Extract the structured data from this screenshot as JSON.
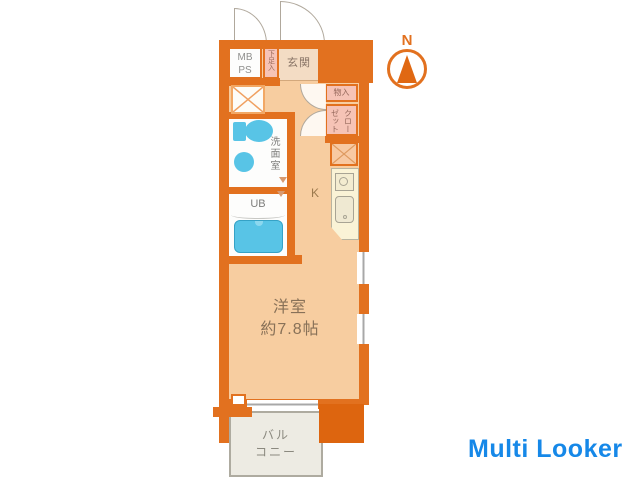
{
  "colors": {
    "wall": "#e2711f",
    "wall_dark": "#dd650f",
    "floor_peach": "#f7cda0",
    "entrance_floor": "#f3dcc4",
    "storage_pink": "#f6c3b6",
    "fixture_blue": "#58c4e6",
    "kitchen_cream": "#faf3d6",
    "balcony_fill": "#edebe3",
    "label_gray": "#7e7e7c",
    "room_label_brown": "#887158",
    "watermark_blue": "#1688e8",
    "compass_orange": "#e2711f"
  },
  "plan": {
    "mbps": {
      "line1": "MB",
      "line2": "PS"
    },
    "shoe_storage": "下足入",
    "entrance": "玄関",
    "storage": "物入",
    "closet": "クローゼット",
    "washroom": "洗面室",
    "unit_bath": "UB",
    "kitchen": "K",
    "main_room": {
      "name": "洋室",
      "size": "約7.8帖"
    },
    "balcony": {
      "line1": "バル",
      "line2": "コニー"
    },
    "compass": "N"
  },
  "icons": {
    "washer_space": "x-cross-icon",
    "refrigerator_space": "hatch-icon",
    "stove": "stove-burner-icon",
    "sink": "kitchen-sink-icon",
    "toilet": "toilet-icon",
    "basin": "washbasin-icon",
    "bathtub": "bathtub-icon",
    "compass_needle": "north-needle-icon"
  },
  "watermark": "Multi Looker"
}
